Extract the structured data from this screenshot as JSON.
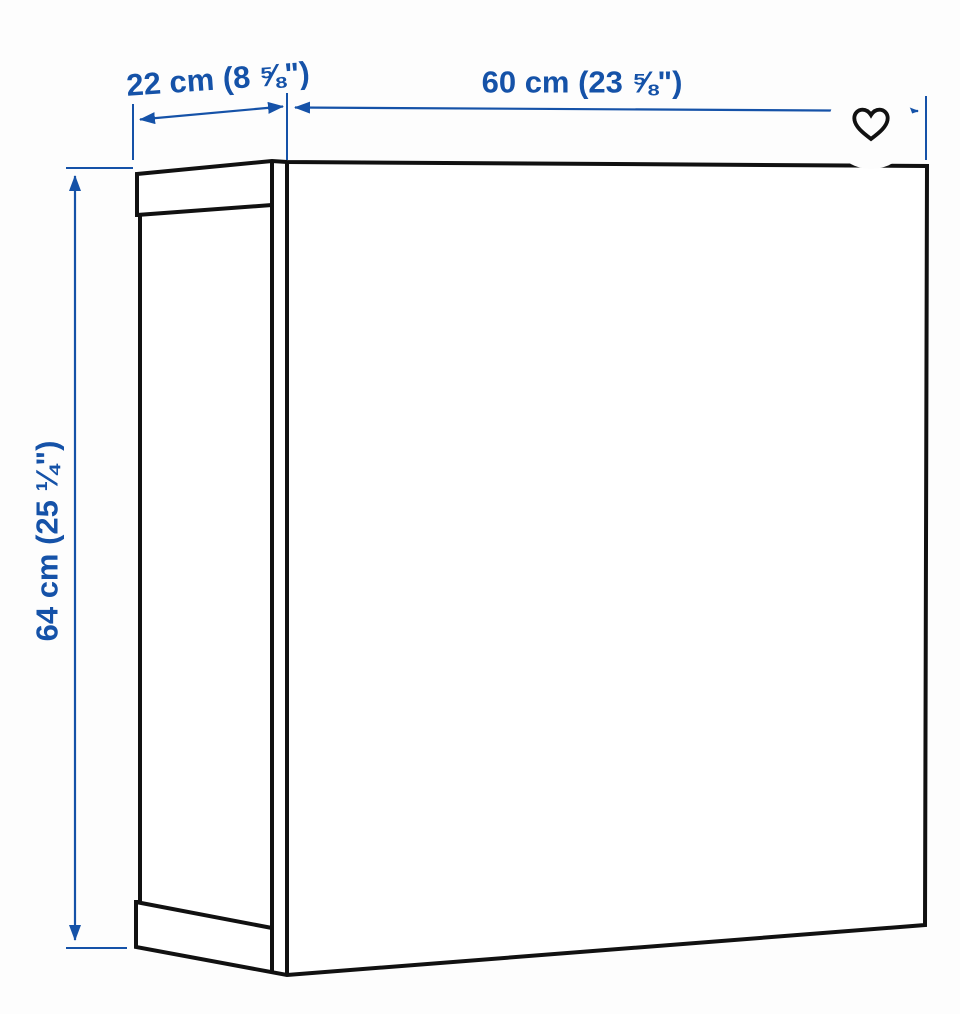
{
  "colors": {
    "dim_blue": "#1552a8",
    "line_black": "#111111",
    "canvas_bg": "#fdfdfd"
  },
  "product_drawing": {
    "description_name": "wall-cabinet-line-drawing",
    "dimensions": {
      "depth_label": "22 cm (8 ⅝\")",
      "width_label": "60 cm (23 ⅝\")",
      "height_label": "64 cm (25 ¼\")"
    }
  },
  "actions": {
    "favorite_icon": "heart-icon"
  }
}
